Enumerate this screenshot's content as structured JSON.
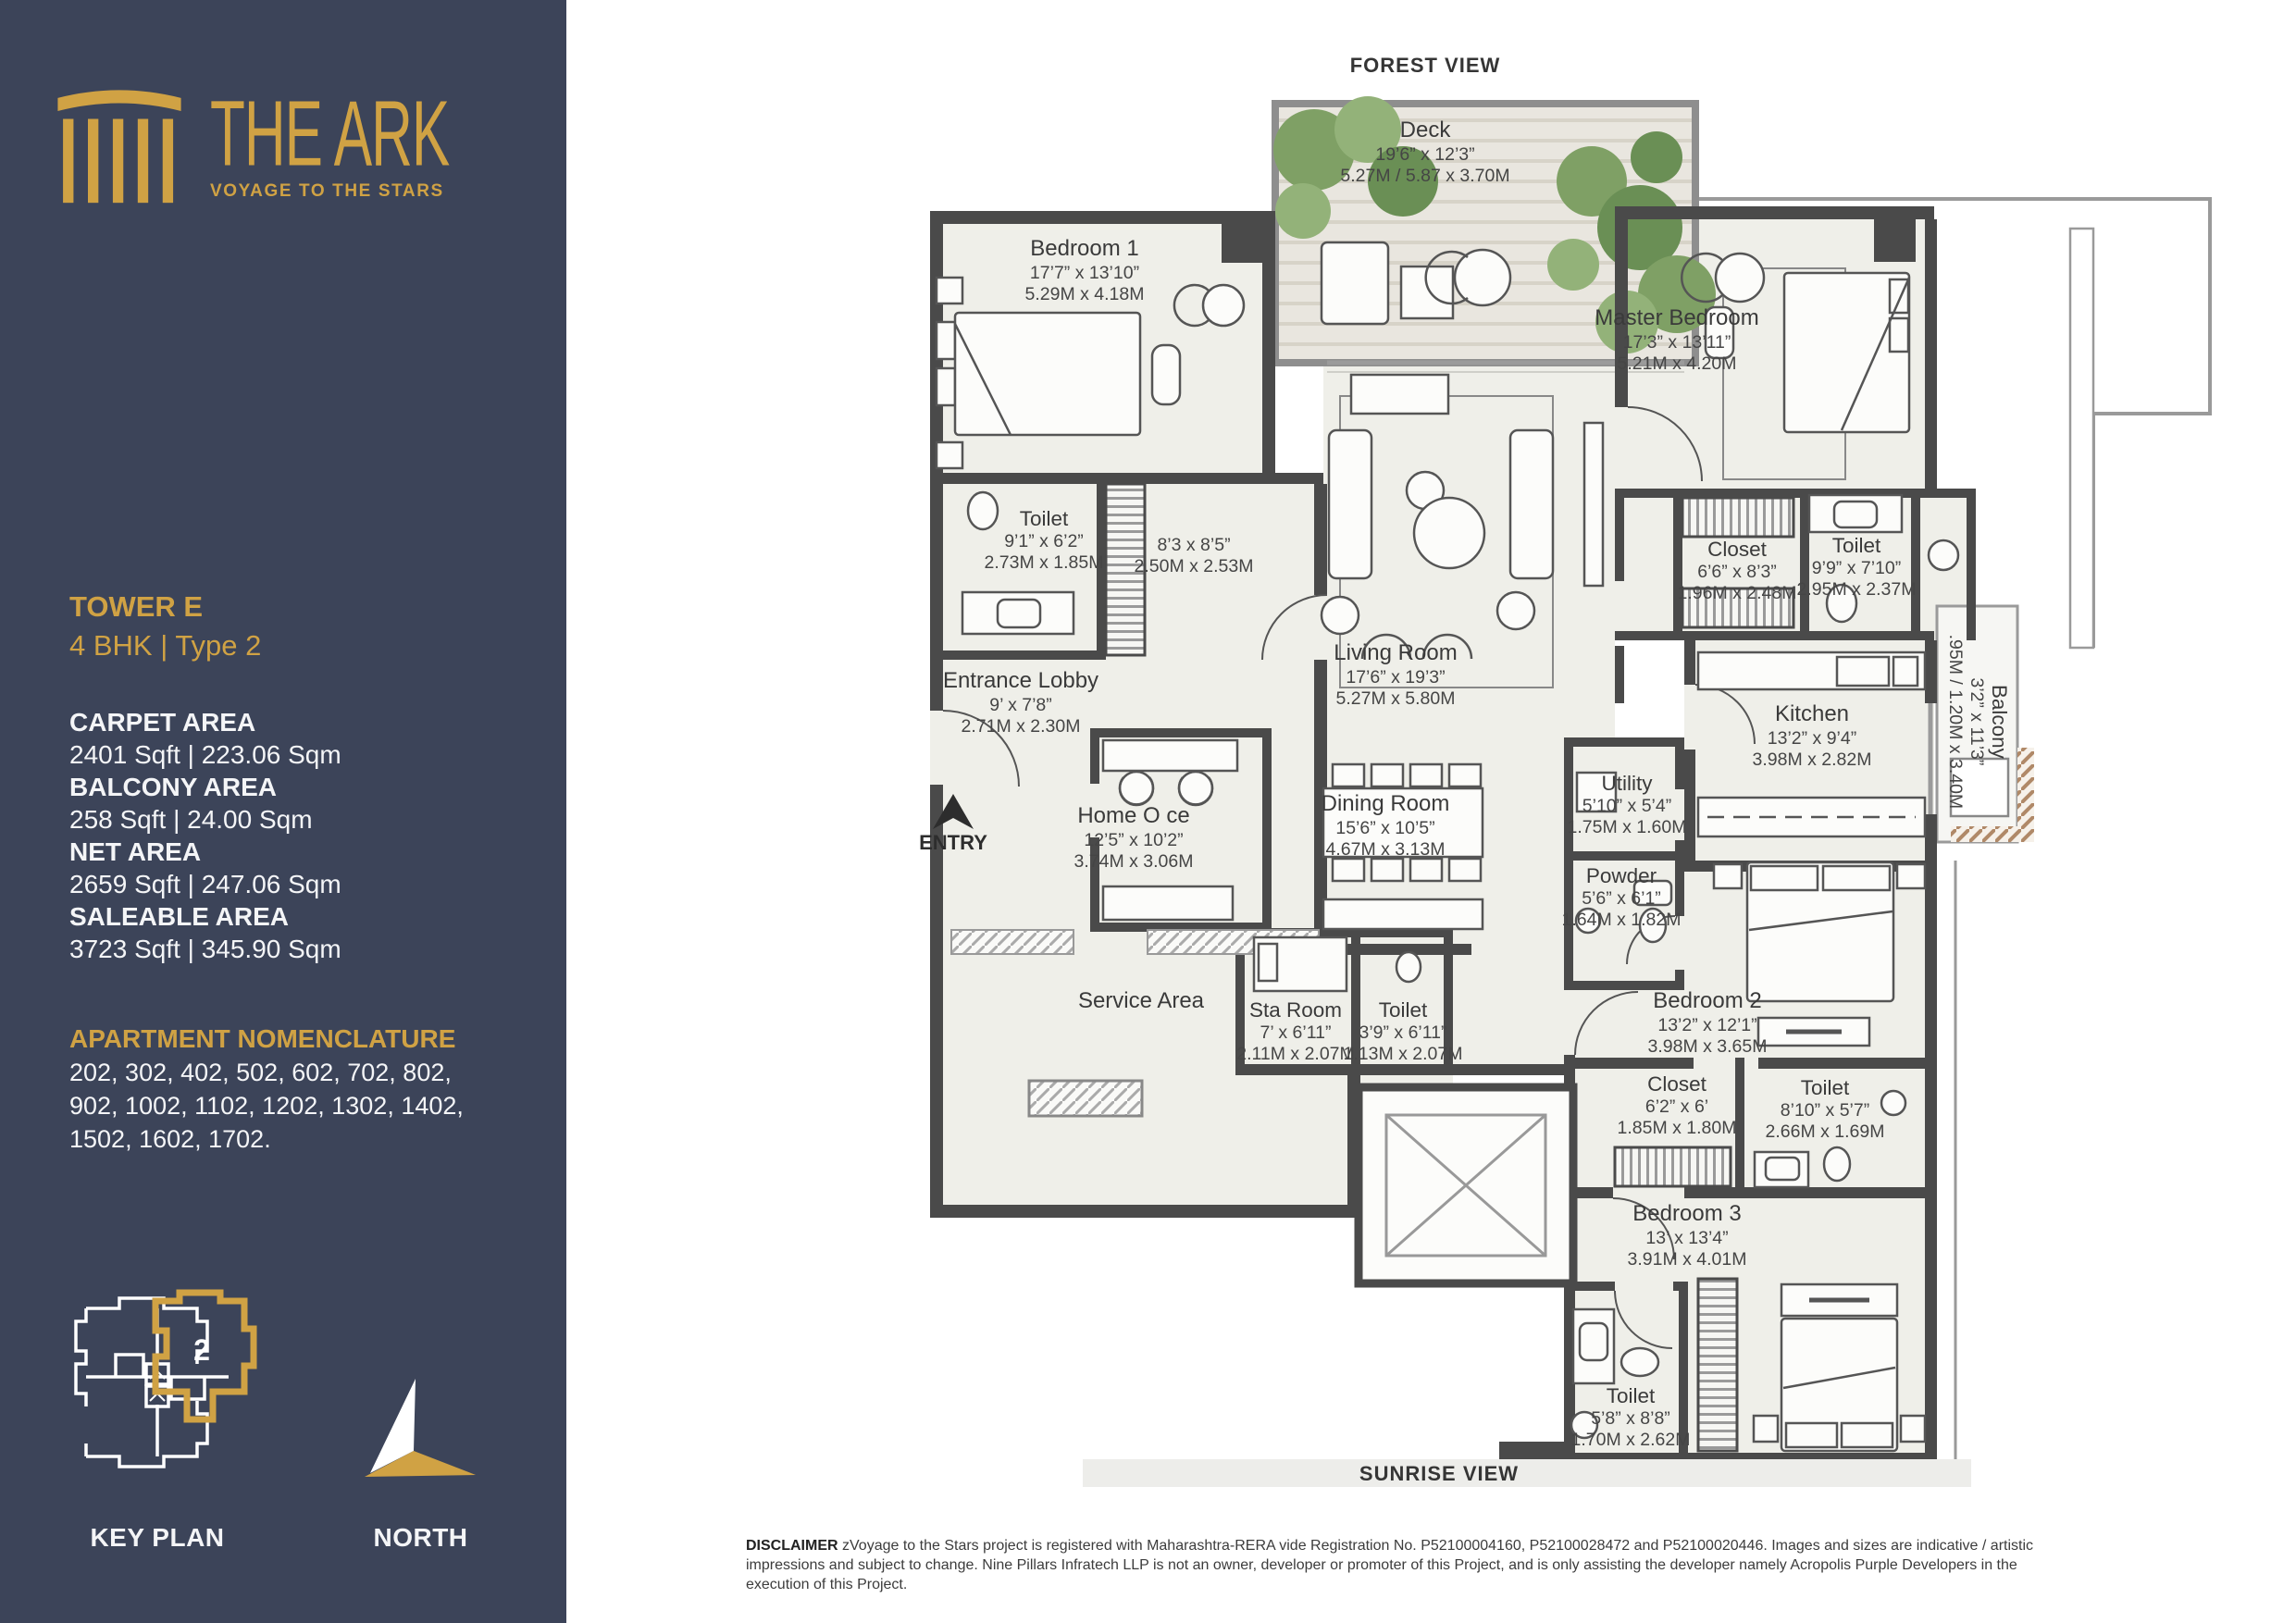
{
  "brand": {
    "name": "THE ARK",
    "tagline": "VOYAGE TO THE STARS"
  },
  "colors": {
    "sidebar_navy": "#3c4459",
    "gold": "#d0a244",
    "wall_gray": "#4a4a4a",
    "floor": "#efefe9"
  },
  "sidebar": {
    "tower": "TOWER E",
    "type": "4 BHK | Type 2",
    "areas": [
      {
        "label": "CARPET AREA",
        "value": "2401 Sqft | 223.06 Sqm"
      },
      {
        "label": "BALCONY AREA",
        "value": "258 Sqft | 24.00 Sqm"
      },
      {
        "label": "NET AREA",
        "value": "2659 Sqft | 247.06 Sqm"
      },
      {
        "label": "SALEABLE AREA",
        "value": "3723 Sqft | 345.90 Sqm"
      }
    ],
    "nomenclature": {
      "label": "APARTMENT NOMENCLATURE",
      "line1": "202, 302, 402, 502, 602, 702, 802,",
      "line2": "902, 1002, 1102, 1202, 1302, 1402,",
      "line3": "1502, 1602, 1702."
    },
    "key_plan": {
      "label": "KEY PLAN",
      "unit": "2"
    },
    "north": {
      "label": "NORTH"
    }
  },
  "plan": {
    "top_view": "FOREST VIEW",
    "bottom_view": "SUNRISE VIEW",
    "entry_label": "ENTRY",
    "rooms": [
      {
        "name": "Deck",
        "dims_ft": "19’6” x 12’3”",
        "dims_m": "5.27M / 5.87 x 3.70M"
      },
      {
        "name": "Bedroom 1",
        "dims_ft": "17’7” x 13’10”",
        "dims_m": "5.29M x 4.18M"
      },
      {
        "name": "Toilet",
        "dims_ft": "9’1” x 6’2”",
        "dims_m": "2.73M x 1.85M"
      },
      {
        "name": "",
        "dims_ft": "8’3 x 8’5”",
        "dims_m": "2.50M x 2.53M"
      },
      {
        "name": "Entrance Lobby",
        "dims_ft": "9’ x 7’8”",
        "dims_m": "2.71M x 2.30M"
      },
      {
        "name": "Home O ce",
        "dims_ft": "12’5” x 10’2”",
        "dims_m": "3.74M x 3.06M"
      },
      {
        "name": "Living Room",
        "dims_ft": "17’6” x 19’3”",
        "dims_m": "5.27M x 5.80M"
      },
      {
        "name": "Dining Room",
        "dims_ft": "15’6” x 10’5”",
        "dims_m": "4.67M x 3.13M"
      },
      {
        "name": "Master Bedroom",
        "dims_ft": "17’3” x 13’11”",
        "dims_m": "5.21M x 4.20M"
      },
      {
        "name": "Closet",
        "dims_ft": "6’6” x 8’3”",
        "dims_m": "1.96M x 2.48M"
      },
      {
        "name": "Toilet",
        "dims_ft": "9’9” x 7’10”",
        "dims_m": "2.95M x 2.37M"
      },
      {
        "name": "Kitchen",
        "dims_ft": "13’2” x 9’4”",
        "dims_m": "3.98M x 2.82M"
      },
      {
        "name": "Balcony",
        "dims_ft": "3’2” x 11’3”",
        "dims_m": ".95M / 1.20M x 3.40M"
      },
      {
        "name": "Utility",
        "dims_ft": "5’10” x 5’4”",
        "dims_m": "1.75M x 1.60M"
      },
      {
        "name": "Powder",
        "dims_ft": "5’6” x 6’1”",
        "dims_m": "1.64M x 1.82M"
      },
      {
        "name": "Service Area",
        "dims_ft": "",
        "dims_m": ""
      },
      {
        "name": "Sta  Room",
        "dims_ft": "7’ x 6’11”",
        "dims_m": "2.11M x 2.07M"
      },
      {
        "name": "Toilet",
        "dims_ft": "3’9” x 6’11”",
        "dims_m": "1.13M x 2.07M"
      },
      {
        "name": "Bedroom 2",
        "dims_ft": "13’2” x 12’1”",
        "dims_m": "3.98M x 3.65M"
      },
      {
        "name": "Closet",
        "dims_ft": "6’2” x 6’",
        "dims_m": "1.85M x 1.80M"
      },
      {
        "name": "Toilet",
        "dims_ft": "8’10” x 5’7”",
        "dims_m": "2.66M x 1.69M"
      },
      {
        "name": "Bedroom 3",
        "dims_ft": "13’ x 13’4”",
        "dims_m": "3.91M x 4.01M"
      },
      {
        "name": "Toilet",
        "dims_ft": "5’8” x 8’8”",
        "dims_m": "1.70M x 2.62M"
      }
    ]
  },
  "disclaimer": {
    "label": "DISCLAIMER",
    "text": "zVoyage to the Stars  project is registered with Maharashtra-RERA vide Registration No. P52100004160, P52100028472 and P52100020446. Images and sizes are indicative / artistic impressions and subject to change. Nine Pillars Infratech LLP is not an owner, developer or promoter of this Project, and is only assisting the developer namely Acropolis Purple Developers in the execution of this Project."
  }
}
